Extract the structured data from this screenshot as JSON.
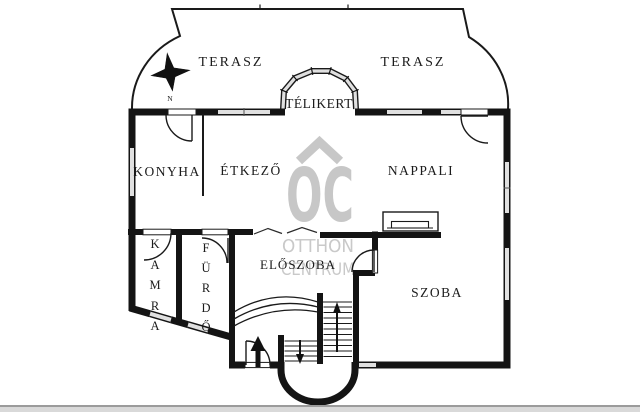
{
  "plan": {
    "title": "floor plan",
    "rooms": {
      "terasz_left": "TERASZ",
      "terasz_right": "TERASZ",
      "telikert": "TÉLIKERT",
      "konyha": "KONYHA",
      "etkezo": "ÉTKEZŐ",
      "nappali": "NAPPALI",
      "eloszoba": "ELŐSZOBA",
      "szoba": "SZOBA",
      "kamra_letters": [
        "K",
        "A",
        "M",
        "R",
        "A"
      ],
      "furdo_letters": [
        "F",
        "Ü",
        "R",
        "D",
        "Ő"
      ]
    },
    "compass": {
      "north_label": "N"
    },
    "watermark": {
      "logo": "OC",
      "line1": "OTTHON",
      "line2": "CENTRUM",
      "color": "#c7c7c7"
    },
    "colors": {
      "wall": "#141414",
      "thin_line": "#1a1a1a",
      "window_fill": "#e0e0e0",
      "background": "#ffffff"
    }
  }
}
